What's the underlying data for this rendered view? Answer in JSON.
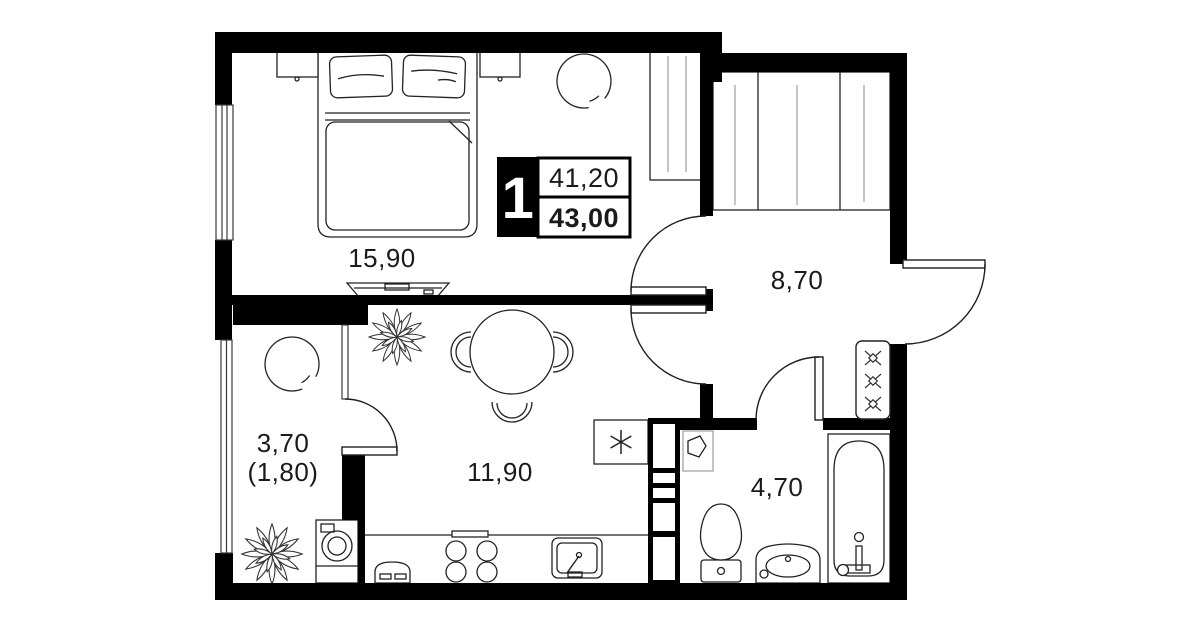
{
  "plan": {
    "badge": {
      "rooms_count": "1",
      "area_living": "41,20",
      "area_total": "43,00"
    },
    "rooms": {
      "bedroom": {
        "area": "15,90"
      },
      "hallway": {
        "area": "8,70"
      },
      "loggia": {
        "area": "3,70",
        "area_reduced": "(1,80)"
      },
      "kitchen": {
        "area": "11,90"
      },
      "bathroom": {
        "area": "4,70"
      }
    },
    "colors": {
      "wall": "#000000",
      "background": "#ffffff",
      "text": "#1a1a1a"
    }
  }
}
